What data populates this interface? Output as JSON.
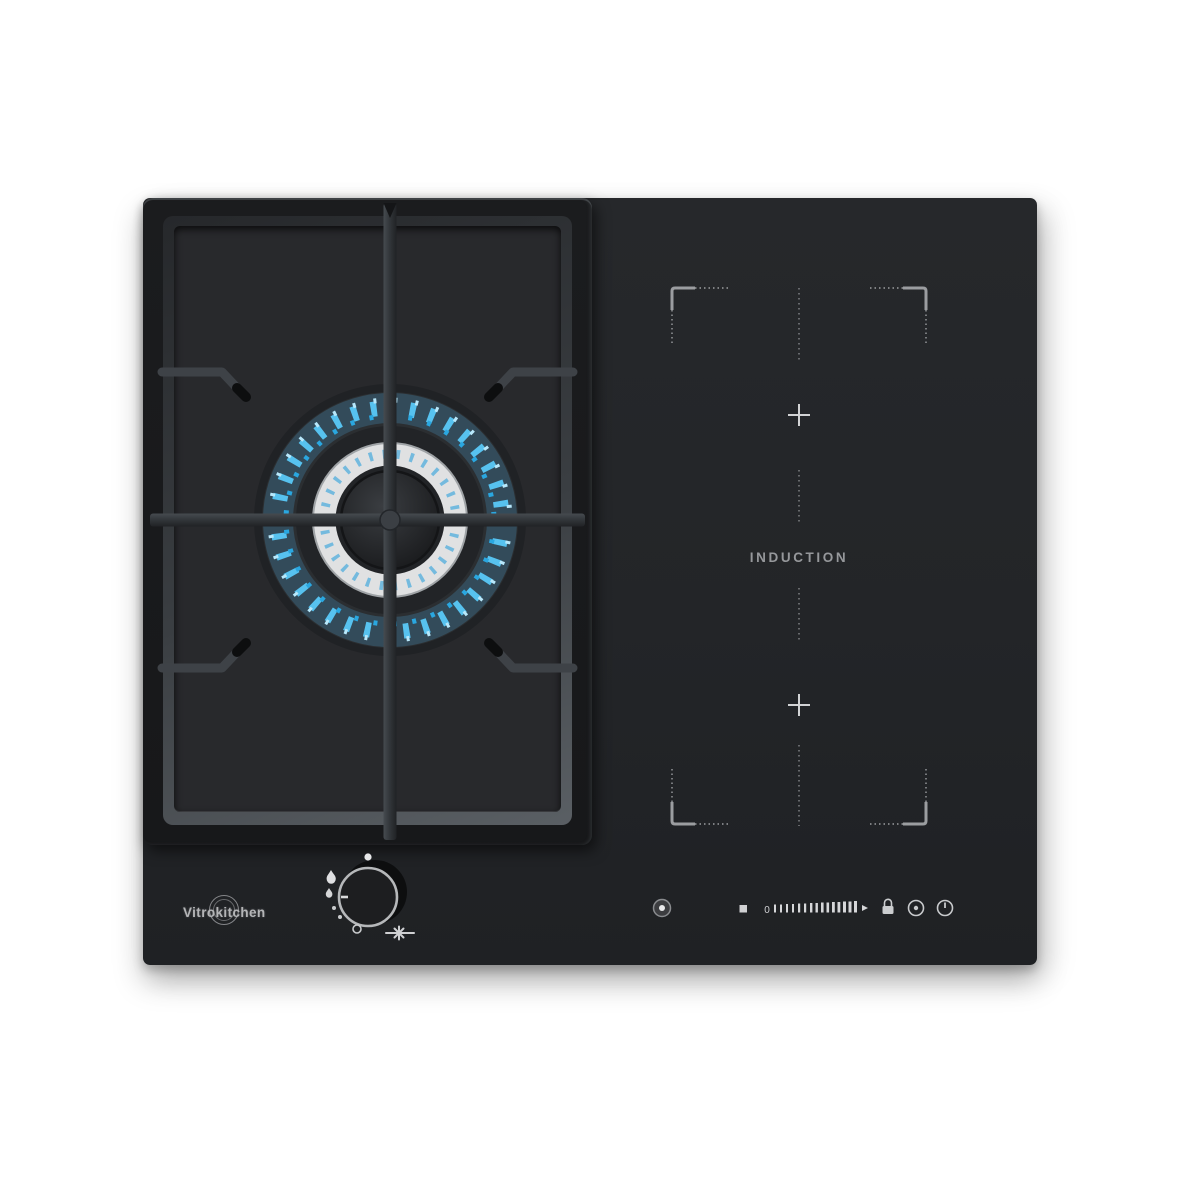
{
  "brand": {
    "logo_text": "Vitrokitchen"
  },
  "induction": {
    "label": "INDUCTION",
    "zones": {
      "marker": "+",
      "marker_count": 2,
      "frame": "corner-brackets-with-dashed-centerline"
    },
    "touch_controls": {
      "slider_min_label": "0",
      "icons": [
        "power-sensor-icon",
        "stop-icon",
        "power-level-slider",
        "lock-icon",
        "timer-icon",
        "power-icon"
      ]
    }
  },
  "gas": {
    "burner": "single-wok-burner-blue-flame",
    "knob_icons": [
      "off-dot-icon",
      "flame-max-icon",
      "flame-min-icon",
      "simmer-dots",
      "min-circle-icon",
      "ignition-spark-icon"
    ]
  },
  "colors": {
    "glass_black": "#232528",
    "flame_blue": "#57c2ef",
    "flame_light": "#b8e8fb",
    "chrome": "#e0e1e2",
    "marking_gray": "#97999c",
    "brand_gray": "#b4b5b7"
  }
}
